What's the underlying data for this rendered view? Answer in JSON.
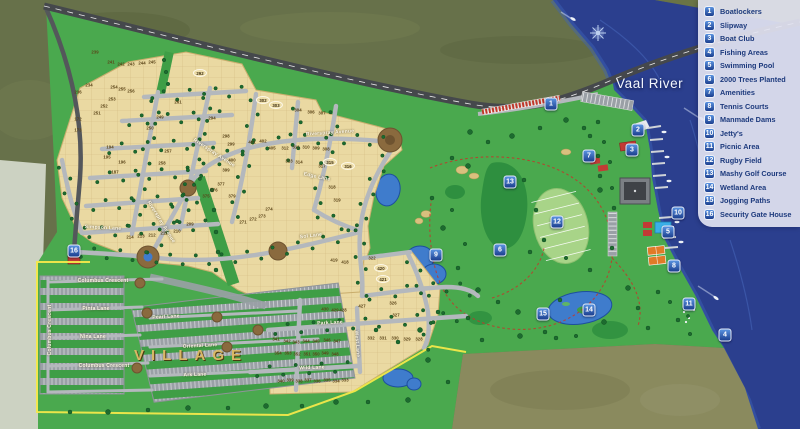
{
  "map": {
    "river_label": "Vaal River",
    "village_label": "VILLAGE",
    "colors": {
      "river": "#2b3f8e",
      "river_shallow": "#3f63b8",
      "land_green": "#4aa94e",
      "golf_dark": "#2e8f3f",
      "plot_tan": "#ead9a2",
      "road_gray": "#b4b8bd",
      "highway": "#45484c",
      "olive_top": "#67714a",
      "olive_se": "#8a8a5e",
      "pale_edge": "#ccd2c2",
      "legend_bg": "#e2e3f1",
      "legend_text": "#1d3a7d",
      "marker_top": "#5a93e0",
      "marker_bottom": "#1c3f8f",
      "boundary_yellow": "#f3e84a",
      "village_text": "#d8b866"
    },
    "legend": {
      "items": [
        {
          "n": "1",
          "label": "Boatlockers"
        },
        {
          "n": "2",
          "label": "Slipway"
        },
        {
          "n": "3",
          "label": "Boat Club"
        },
        {
          "n": "4",
          "label": "Fishing Areas"
        },
        {
          "n": "5",
          "label": "Swimming Pool"
        },
        {
          "n": "6",
          "label": "2000 Trees Planted"
        },
        {
          "n": "7",
          "label": "Amenities"
        },
        {
          "n": "8",
          "label": "Tennis Courts"
        },
        {
          "n": "9",
          "label": "Manmade Dams"
        },
        {
          "n": "10",
          "label": "Jetty's"
        },
        {
          "n": "11",
          "label": "Picnic Area"
        },
        {
          "n": "12",
          "label": "Rugby Field"
        },
        {
          "n": "13",
          "label": "Mashy Golf Course"
        },
        {
          "n": "14",
          "label": "Wetland Area"
        },
        {
          "n": "15",
          "label": "Jogging Paths"
        },
        {
          "n": "16",
          "label": "Security Gate House"
        }
      ]
    },
    "markers": [
      {
        "n": "1",
        "label": "Boatlockers",
        "x": 551,
        "y": 104
      },
      {
        "n": "2",
        "label": "Slipway",
        "x": 638,
        "y": 130
      },
      {
        "n": "3",
        "label": "Boat Club",
        "x": 632,
        "y": 150
      },
      {
        "n": "4",
        "label": "Fishing Areas",
        "x": 725,
        "y": 335
      },
      {
        "n": "5",
        "label": "Swimming Pool",
        "x": 668,
        "y": 232
      },
      {
        "n": "6",
        "label": "2000 Trees Planted",
        "x": 500,
        "y": 250
      },
      {
        "n": "7",
        "label": "Amenities",
        "x": 589,
        "y": 156
      },
      {
        "n": "8",
        "label": "Tennis Courts",
        "x": 674,
        "y": 266
      },
      {
        "n": "9",
        "label": "Manmade Dams",
        "x": 436,
        "y": 255
      },
      {
        "n": "10",
        "label": "Jetty's",
        "x": 678,
        "y": 213
      },
      {
        "n": "11",
        "label": "Picnic Area",
        "x": 689,
        "y": 304
      },
      {
        "n": "12",
        "label": "Rugby Field",
        "x": 557,
        "y": 222
      },
      {
        "n": "13",
        "label": "Mashy Golf Course",
        "x": 510,
        "y": 182
      },
      {
        "n": "14",
        "label": "Wetland Area",
        "x": 589,
        "y": 310
      },
      {
        "n": "15",
        "label": "Jogging Paths",
        "x": 543,
        "y": 314
      },
      {
        "n": "16",
        "label": "Security Gate House",
        "x": 74,
        "y": 251
      }
    ],
    "street_labels": [
      {
        "text": "Riverspray Avenue",
        "x": 330,
        "y": 133,
        "rot": -4
      },
      {
        "text": "Riverspray Avenue",
        "x": 214,
        "y": 153,
        "rot": 33
      },
      {
        "text": "Riverspray Avenue",
        "x": 161,
        "y": 222,
        "rot": 58
      },
      {
        "text": "Simpson Lane",
        "x": 103,
        "y": 228,
        "rot": 3
      },
      {
        "text": "Edge Lane",
        "x": 317,
        "y": 177,
        "rot": 12
      },
      {
        "text": "Sol Lane",
        "x": 311,
        "y": 236,
        "rot": -7
      },
      {
        "text": "Park Lane",
        "x": 330,
        "y": 323,
        "rot": -3
      },
      {
        "text": "Wild Lane",
        "x": 312,
        "y": 368,
        "rot": -2
      },
      {
        "text": "West Lane",
        "x": 357,
        "y": 344,
        "rot": 86
      },
      {
        "text": "Columbus Crescent",
        "x": 103,
        "y": 281,
        "rot": 0
      },
      {
        "text": "Pinta Lane",
        "x": 96,
        "y": 309,
        "rot": 0
      },
      {
        "text": "Nina Lane",
        "x": 93,
        "y": 337,
        "rot": 0
      },
      {
        "text": "Columbus Crescent",
        "x": 104,
        "y": 366,
        "rot": 0
      },
      {
        "text": "Columbus Crescent",
        "x": 50,
        "y": 330,
        "rot": -90
      },
      {
        "text": "Pearl Lane",
        "x": 166,
        "y": 317,
        "rot": -3
      },
      {
        "text": "Oriental Lane",
        "x": 200,
        "y": 346,
        "rot": -3
      },
      {
        "text": "Ark Lane",
        "x": 195,
        "y": 375,
        "rot": -2
      }
    ],
    "plot_numbers": [
      [
        "239",
        95,
        52
      ],
      [
        "241",
        111,
        62
      ],
      [
        "242",
        121,
        64
      ],
      [
        "243",
        131,
        64
      ],
      [
        "244",
        142,
        63
      ],
      [
        "245",
        152,
        62
      ],
      [
        "234",
        89,
        85
      ],
      [
        "236",
        78,
        92
      ],
      [
        "254",
        114,
        87
      ],
      [
        "255",
        122,
        89
      ],
      [
        "256",
        131,
        91
      ],
      [
        "253",
        112,
        99
      ],
      [
        "252",
        104,
        106
      ],
      [
        "251",
        97,
        113
      ],
      [
        "172",
        78,
        119
      ],
      [
        "173",
        78,
        130
      ],
      [
        "194",
        110,
        147
      ],
      [
        "195",
        107,
        157
      ],
      [
        "196",
        122,
        162
      ],
      [
        "187",
        115,
        172
      ],
      [
        "249",
        160,
        117
      ],
      [
        "250",
        150,
        128
      ],
      [
        "257",
        168,
        151
      ],
      [
        "258",
        162,
        163
      ],
      [
        "261",
        178,
        102
      ],
      [
        "294",
        212,
        118
      ],
      [
        "298",
        226,
        136
      ],
      [
        "299",
        231,
        144
      ],
      [
        "401",
        252,
        142
      ],
      [
        "402",
        263,
        141
      ],
      [
        "405",
        272,
        148
      ],
      [
        "400",
        232,
        160
      ],
      [
        "399",
        226,
        170
      ],
      [
        "375",
        206,
        196
      ],
      [
        "376",
        214,
        190
      ],
      [
        "377",
        221,
        184
      ],
      [
        "379",
        232,
        196
      ],
      [
        "304",
        298,
        110
      ],
      [
        "306",
        311,
        112
      ],
      [
        "307",
        322,
        113
      ],
      [
        "312",
        285,
        148
      ],
      [
        "311",
        296,
        147
      ],
      [
        "310",
        306,
        147
      ],
      [
        "309",
        316,
        148
      ],
      [
        "308",
        326,
        149
      ],
      [
        "313",
        289,
        161
      ],
      [
        "314",
        299,
        162
      ],
      [
        "317",
        322,
        166
      ],
      [
        "318",
        332,
        187
      ],
      [
        "319",
        337,
        200
      ],
      [
        "209",
        190,
        224
      ],
      [
        "210",
        177,
        231
      ],
      [
        "211",
        164,
        233
      ],
      [
        "212",
        152,
        235
      ],
      [
        "213",
        141,
        236
      ],
      [
        "214",
        130,
        237
      ],
      [
        "271",
        243,
        222
      ],
      [
        "272",
        253,
        219
      ],
      [
        "273",
        262,
        216
      ],
      [
        "274",
        269,
        209
      ],
      [
        "341",
        276,
        339
      ],
      [
        "342",
        287,
        341
      ],
      [
        "343",
        296,
        342
      ],
      [
        "344",
        306,
        341
      ],
      [
        "345",
        316,
        341
      ],
      [
        "346",
        327,
        340
      ],
      [
        "347",
        337,
        341
      ],
      [
        "332",
        371,
        338
      ],
      [
        "331",
        383,
        338
      ],
      [
        "330",
        395,
        338
      ],
      [
        "329",
        407,
        339
      ],
      [
        "328",
        419,
        339
      ],
      [
        "354",
        278,
        353
      ],
      [
        "353",
        288,
        353
      ],
      [
        "352",
        297,
        354
      ],
      [
        "351",
        307,
        354
      ],
      [
        "350",
        316,
        354
      ],
      [
        "349",
        325,
        353
      ],
      [
        "348",
        335,
        354
      ],
      [
        "340",
        281,
        381
      ],
      [
        "339",
        290,
        380
      ],
      [
        "338",
        299,
        381
      ],
      [
        "337",
        308,
        380
      ],
      [
        "336",
        317,
        381
      ],
      [
        "335",
        327,
        380
      ],
      [
        "334",
        336,
        381
      ],
      [
        "333",
        345,
        380
      ],
      [
        "430",
        325,
        309
      ],
      [
        "429",
        335,
        310
      ],
      [
        "428",
        343,
        310
      ],
      [
        "427",
        362,
        306
      ],
      [
        "326",
        393,
        303
      ],
      [
        "327",
        396,
        315
      ],
      [
        "322",
        372,
        258
      ],
      [
        "418",
        345,
        262
      ],
      [
        "419",
        334,
        260
      ]
    ],
    "oval_plot_badges": [
      [
        "292",
        200,
        73
      ],
      [
        "302",
        263,
        100
      ],
      [
        "303",
        276,
        105
      ],
      [
        "315",
        330,
        162
      ],
      [
        "316",
        348,
        166
      ],
      [
        "420",
        381,
        268
      ],
      [
        "421",
        383,
        279
      ]
    ]
  }
}
